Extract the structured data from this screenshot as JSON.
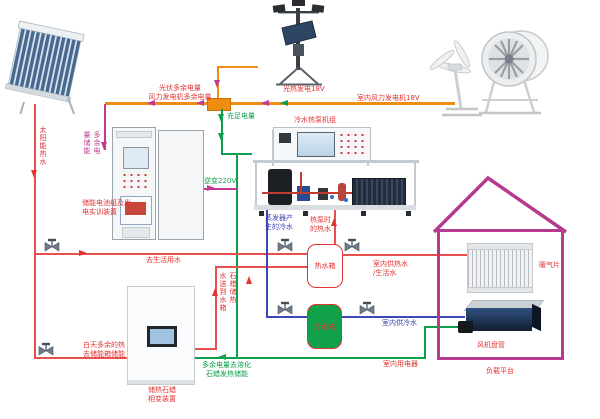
{
  "power": {
    "pv_surplus": "光伏多余电量",
    "wind_surplus": "风力发电机多余电量",
    "surplus_storage": [
      "多余电",
      "量储能"
    ],
    "sufficient": "充足电量",
    "solar_thermal_gen": "光热发电18V",
    "indoor_wind_gen": "室内风力发电机18V",
    "inverter": "逆变220V",
    "melt_paraffin": [
      "多余电量去溶化",
      "石蜡发热储能"
    ],
    "indoor_appliances": "室内用电器"
  },
  "water": {
    "solar_hot": "太阳能热水",
    "to_domestic": "去生活用水",
    "day_surplus": [
      "白天多余的热",
      "去储能箱储能"
    ],
    "paraffin_to_tank": [
      "石蜡储热",
      "水送到水箱"
    ],
    "evap_cold": [
      "蒸发器产",
      "生的冷水"
    ],
    "hp_hot": [
      "热泵时",
      "的热水"
    ],
    "indoor_hot": [
      "室内供热水",
      "/生活水"
    ],
    "indoor_cold": "室内供冷水"
  },
  "equipment": {
    "battery_rig": [
      "储能电池组及发",
      "电实训装置"
    ],
    "heat_pump": "冷水热泵机组",
    "hot_tank": "热水箱",
    "cold_tank": "冷水箱",
    "paraffin": [
      "储热石蜡",
      "相变装置"
    ],
    "radiator": "暖气片",
    "fan_coil": "风机盘管",
    "load_platform": "负载平台"
  },
  "colors": {
    "power_bus_orange": "#ef8c12",
    "surplus_magenta": "#c23a92",
    "charged_green": "#0ca04a",
    "hot_water_red": "#e23333",
    "cold_water_blue": "#3f46b5",
    "house_outline": "#b53b90",
    "cold_tank_fill": "#12a14b"
  }
}
